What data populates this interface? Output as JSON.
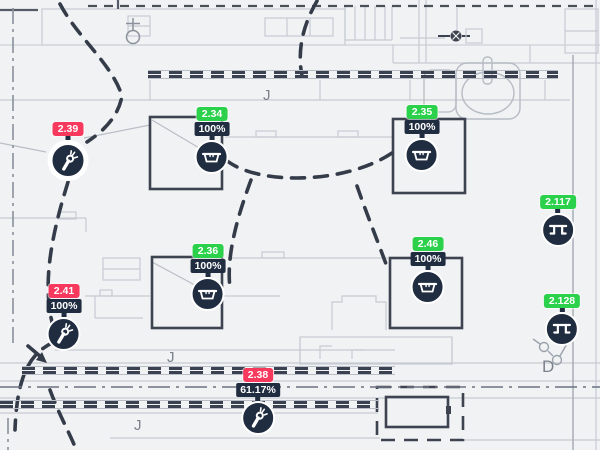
{
  "colors": {
    "green": "#2bd14b",
    "red": "#f8395e",
    "marker_dark": "#202c40",
    "background": "#f1f2f4",
    "plan_light": "#c6cbd2",
    "plan_dark": "#3d4350"
  },
  "sensors": [
    {
      "id": "2.39",
      "status_color": "red",
      "percent": "",
      "icon": "tap-icon"
    },
    {
      "id": "2.34",
      "status_color": "green",
      "percent": "100%",
      "icon": "dispenser-icon"
    },
    {
      "id": "2.35",
      "status_color": "green",
      "percent": "100%",
      "icon": "dispenser-icon"
    },
    {
      "id": "2.117",
      "status_color": "green",
      "percent": "",
      "icon": "stall-icon"
    },
    {
      "id": "2.36",
      "status_color": "green",
      "percent": "100%",
      "icon": "dispenser-icon"
    },
    {
      "id": "2.46",
      "status_color": "green",
      "percent": "100%",
      "icon": "dispenser-icon"
    },
    {
      "id": "2.41",
      "status_color": "red",
      "percent": "100%",
      "icon": "tap-icon"
    },
    {
      "id": "2.128",
      "status_color": "green",
      "percent": "",
      "icon": "stall-icon"
    },
    {
      "id": "2.38",
      "status_color": "red",
      "percent": "61.17%",
      "icon": "tap-icon"
    }
  ],
  "letters": [
    {
      "char": "J"
    },
    {
      "char": "J"
    },
    {
      "char": "J"
    },
    {
      "char": "D"
    }
  ]
}
